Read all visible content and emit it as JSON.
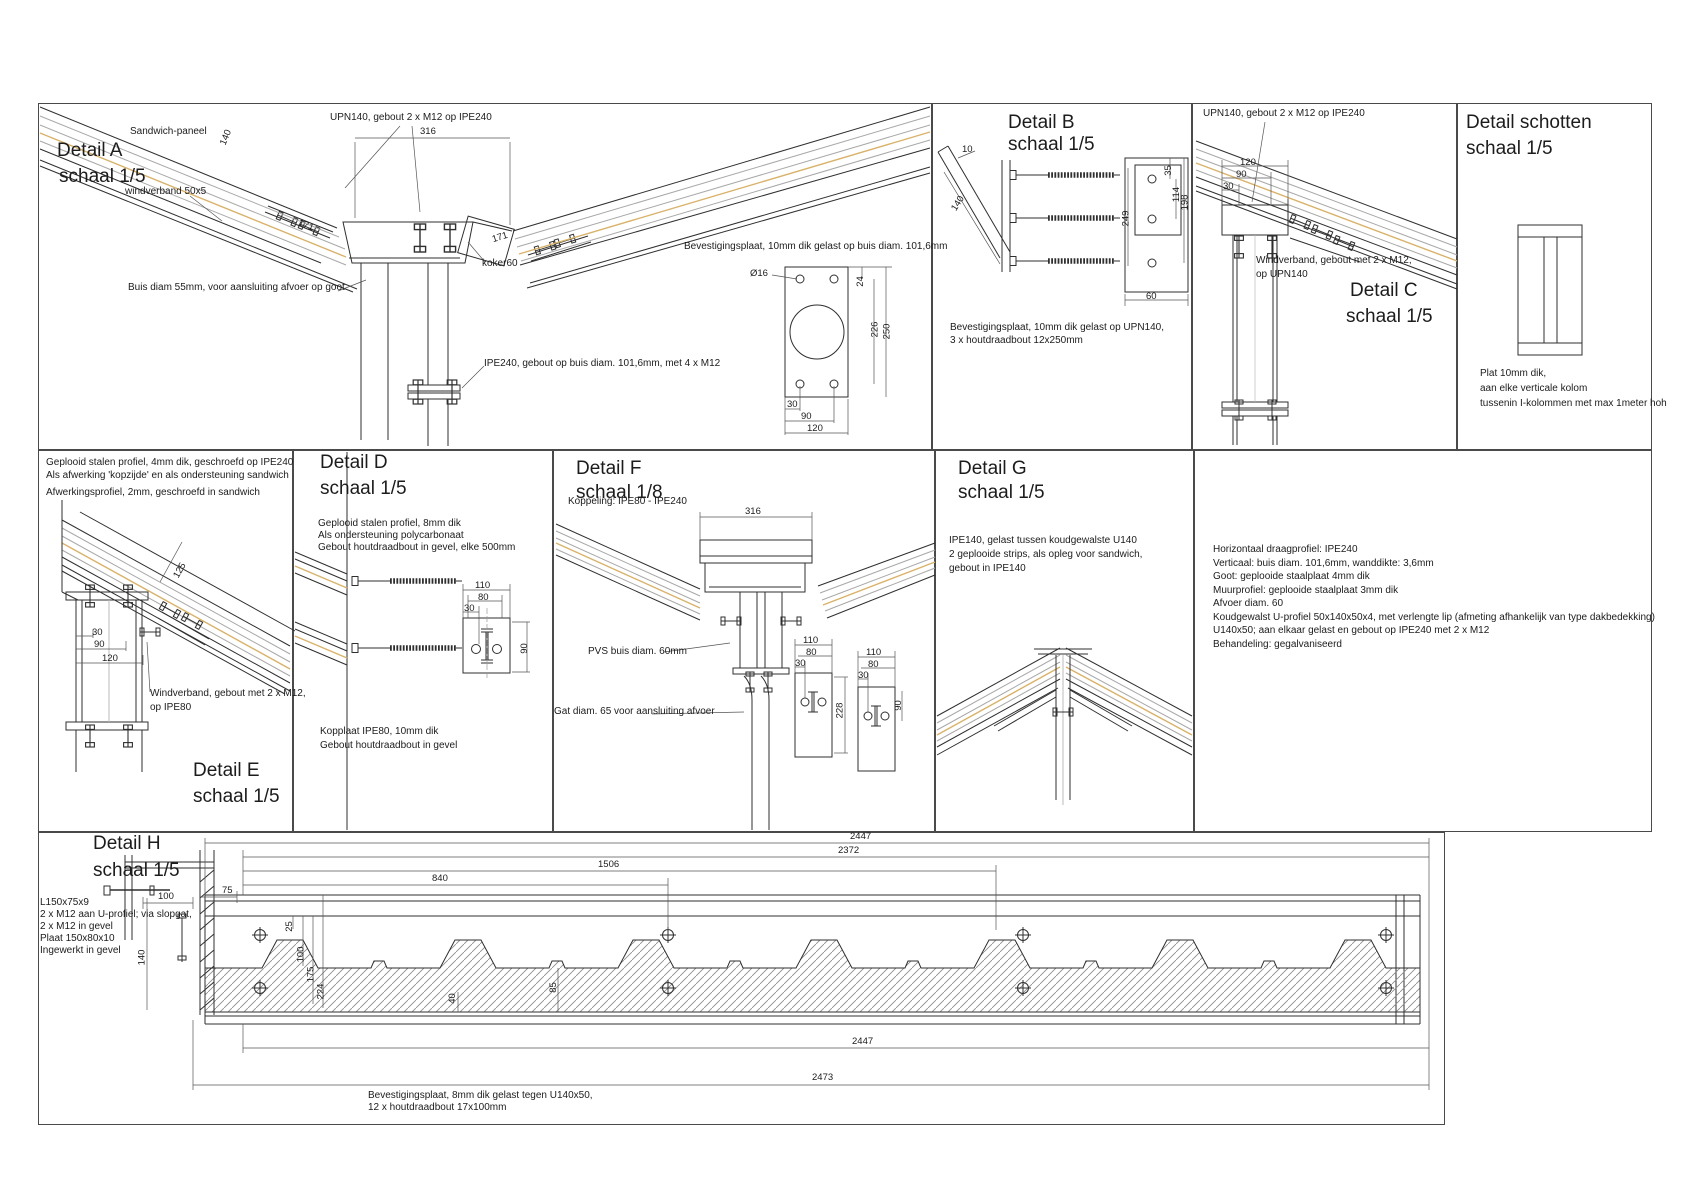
{
  "colors": {
    "ink": "#2f2f2f",
    "soft": "#a8a8a8",
    "tan": "#d9b26a"
  },
  "a": {
    "title": "Detail A",
    "scale": "schaal 1/5",
    "sandwich": "Sandwich-paneel",
    "wind": "windverband 50x5",
    "upn": "UPN140, gebout 2 x M12 op IPE240",
    "buis": "Buis diam 55mm, voor aansluiting afvoer op goot",
    "koker": "koker60",
    "ipe": "IPE240, gebout op buis diam. 101,6mm, met 4 x M12",
    "d316": "316",
    "d140": "140",
    "d171a": "171",
    "d171b": "171"
  },
  "plate": {
    "label": "Bevestigingsplaat, 10mm dik gelast op buis diam. 101,6mm",
    "dia": "Ø16",
    "d24": "24",
    "d226": "226",
    "d250": "250",
    "d30": "30",
    "d90": "90",
    "d120": "120"
  },
  "b": {
    "title": "Detail B",
    "scale": "schaal 1/5",
    "note1": "Bevestigingsplaat, 10mm dik gelast op UPN140,",
    "note2": "3 x houtdraadbout 12x250mm",
    "d10": "10",
    "d140": "140",
    "d249": "249",
    "d35": "35",
    "d114": "114",
    "d198": "198",
    "d60": "60"
  },
  "c": {
    "title": "Detail C",
    "scale": "schaal 1/5",
    "upn": "UPN140, gebout 2 x M12 op IPE240",
    "wind1": "Windverband, gebout met 2 x M12,",
    "wind2": "op UPN140",
    "d120": "120",
    "d90": "90",
    "d30": "30"
  },
  "s": {
    "title": "Detail schotten",
    "scale": "schaal 1/5",
    "note1": "Plat 10mm dik,",
    "note2": "aan elke verticale kolom",
    "note3": "tussenin I-kolommen met max 1meter hoh"
  },
  "e": {
    "title": "Detail E",
    "scale": "schaal 1/5",
    "note1": "Geplooid stalen profiel, 4mm dik, geschroefd op IPE240",
    "note2": "Als afwerking 'kopzijde' en als ondersteuning sandwich",
    "note3": "Afwerkingsprofiel, 2mm, geschroefd in sandwich",
    "wind1": "Windverband, gebout met 2 x M12,",
    "wind2": "op IPE80",
    "d125": "125",
    "d30": "30",
    "d90": "90",
    "d120": "120"
  },
  "d": {
    "title": "Detail D",
    "scale": "schaal 1/5",
    "note1": "Geplooid stalen profiel, 8mm dik",
    "note2": "Als ondersteuning polycarbonaat",
    "note3": "Gebout houtdraadbout in gevel, elke 500mm",
    "kop1": "Kopplaat IPE80, 10mm dik",
    "kop2": "Gebout houtdraadbout in gevel",
    "d110": "110",
    "d80": "80",
    "d30": "30",
    "d90": "90"
  },
  "f": {
    "title": "Detail F",
    "scale": "schaal 1/8",
    "sub": "Koppeling: IPE80 - IPE240",
    "pvs": "PVS buis diam. 60mm",
    "gat": "Gat diam. 65 voor aansluiting afvoer",
    "d316": "316",
    "p1": {
      "d110": "110",
      "d80": "80",
      "d30": "30",
      "d228": "228"
    },
    "p2": {
      "d110": "110",
      "d80": "80",
      "d30": "30",
      "d90": "90"
    }
  },
  "g": {
    "title": "Detail G",
    "scale": "schaal 1/5",
    "note1": "IPE140, gelast tussen koudgewalste U140",
    "note2": "2 geplooide strips, als opleg voor sandwich,",
    "note3": "gebout in IPE140"
  },
  "specs": {
    "lines": [
      "Horizontaal draagprofiel: IPE240",
      "Verticaal: buis diam. 101,6mm, wanddikte: 3,6mm",
      "Goot: geplooide staalplaat 4mm dik",
      "Muurprofiel: geplooide staalplaat 3mm dik",
      "Afvoer diam. 60",
      "Koudgewalst U-profiel 50x140x50x4, met verlengte lip (afmeting afhankelijk van type dakbedekking)",
      "U140x50; aan elkaar gelast en gebout op IPE240 met 2 x M12",
      "Behandeling: gegalvaniseerd"
    ]
  },
  "h": {
    "title": "Detail H",
    "scale": "schaal 1/5",
    "notes": [
      "L150x75x9",
      "2 x M12 aan U-profiel; via slopgat,",
      "2 x M12 in gevel",
      "Plaat 150x80x10",
      "Ingewerkt in gevel"
    ],
    "bot1": "Bevestigingsplaat, 8mm dik gelast tegen U140x50,",
    "bot2": "12 x houtdraadbout 17x100mm",
    "d2447t": "2447",
    "d2372": "2372",
    "d1506": "1506",
    "d840": "840",
    "d75": "75",
    "d100": "100",
    "d25": "25",
    "d100b": "100",
    "d175": "175",
    "d224": "224",
    "d140": "140",
    "d40": "40",
    "d85": "85",
    "d2447b": "2447",
    "d2473": "2473"
  }
}
